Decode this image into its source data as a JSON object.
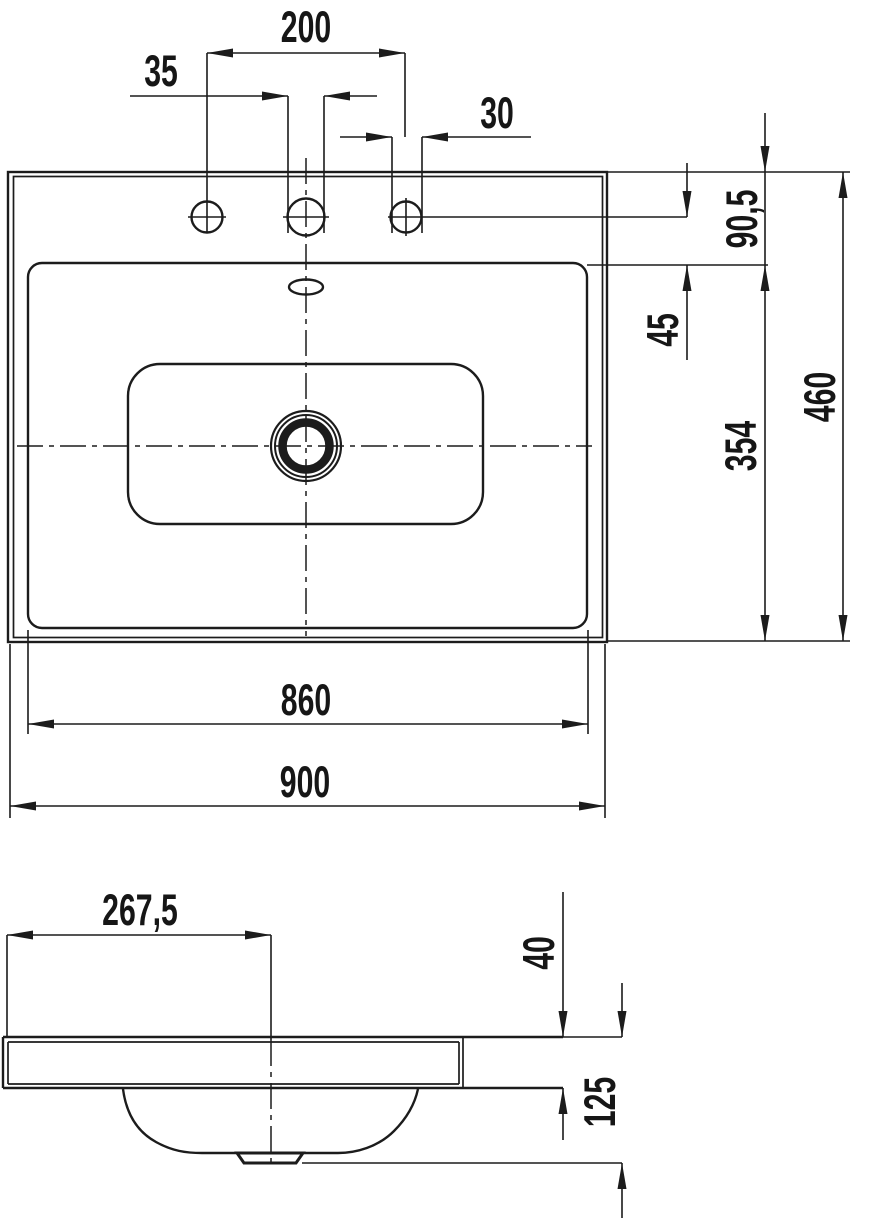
{
  "drawing": {
    "title": "washbasin-technical-drawing",
    "background": "#ffffff",
    "line_color": "#1c1c1c",
    "units": "mm",
    "top_view": {
      "hole_spacing": "200",
      "center_hole_diameter": "35",
      "side_hole_diameter": "30",
      "back_edge_to_hole_center": "90,5",
      "hole_center_to_rim": "45",
      "rim_depth": "354",
      "overall_depth": "460",
      "rim_width": "860",
      "overall_width": "900"
    },
    "side_view": {
      "edge_to_drain_center": "267,5",
      "slab_thickness": "40",
      "overall_height": "125"
    }
  }
}
